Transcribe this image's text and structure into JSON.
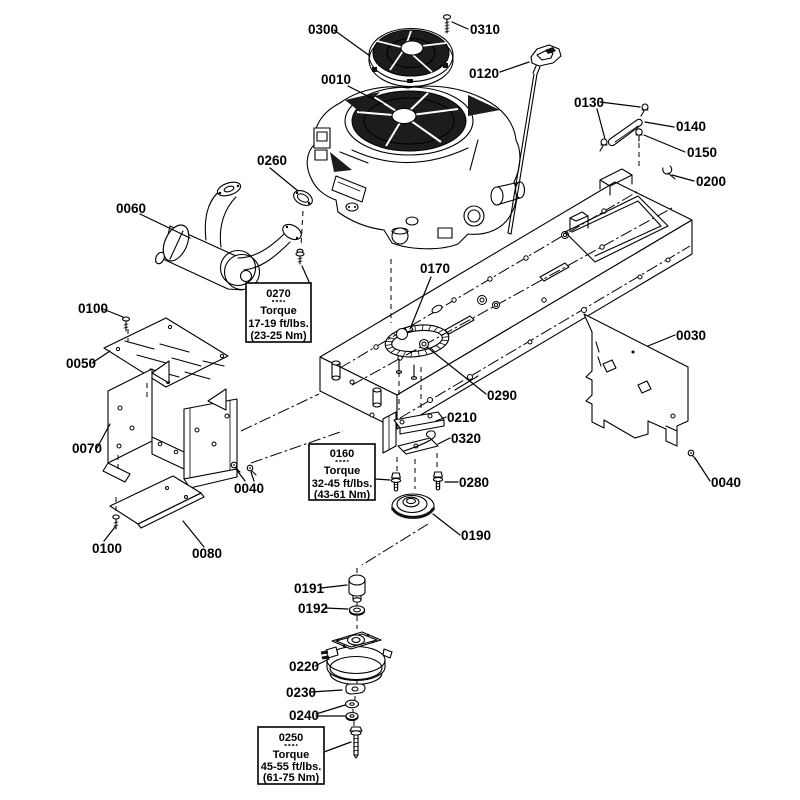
{
  "colors": {
    "line": "#000000",
    "background": "#ffffff",
    "dark": "#1c1c1c"
  },
  "part_labels": [
    {
      "part": "0300"
    },
    {
      "part": "0310"
    },
    {
      "part": "0010"
    },
    {
      "part": "0120"
    },
    {
      "part": "0130"
    },
    {
      "part": "0140"
    },
    {
      "part": "0150"
    },
    {
      "part": "0200"
    },
    {
      "part": "0260"
    },
    {
      "part": "0060"
    },
    {
      "part": "0100"
    },
    {
      "part": "0050"
    },
    {
      "part": "0070"
    },
    {
      "part": "0040"
    },
    {
      "part": "0080"
    },
    {
      "part": "0100"
    },
    {
      "part": "0170"
    },
    {
      "part": "0290"
    },
    {
      "part": "0030"
    },
    {
      "part": "0040"
    },
    {
      "part": "0210"
    },
    {
      "part": "0320"
    },
    {
      "part": "0280"
    },
    {
      "part": "0190"
    },
    {
      "part": "0191"
    },
    {
      "part": "0192"
    },
    {
      "part": "0220"
    },
    {
      "part": "0230"
    },
    {
      "part": "0240"
    }
  ],
  "torque_boxes": [
    {
      "part": "0270",
      "torque_word": "Torque",
      "ftlbs": "17-19 ft/lbs.",
      "nm": "(23-25 Nm)"
    },
    {
      "part": "0160",
      "torque_word": "Torque",
      "ftlbs": "32-45 ft/lbs.",
      "nm": "(43-61 Nm)"
    },
    {
      "part": "0250",
      "torque_word": "Torque",
      "ftlbs": "45-55 ft/lbs.",
      "nm": "(61-75 Nm)"
    }
  ]
}
